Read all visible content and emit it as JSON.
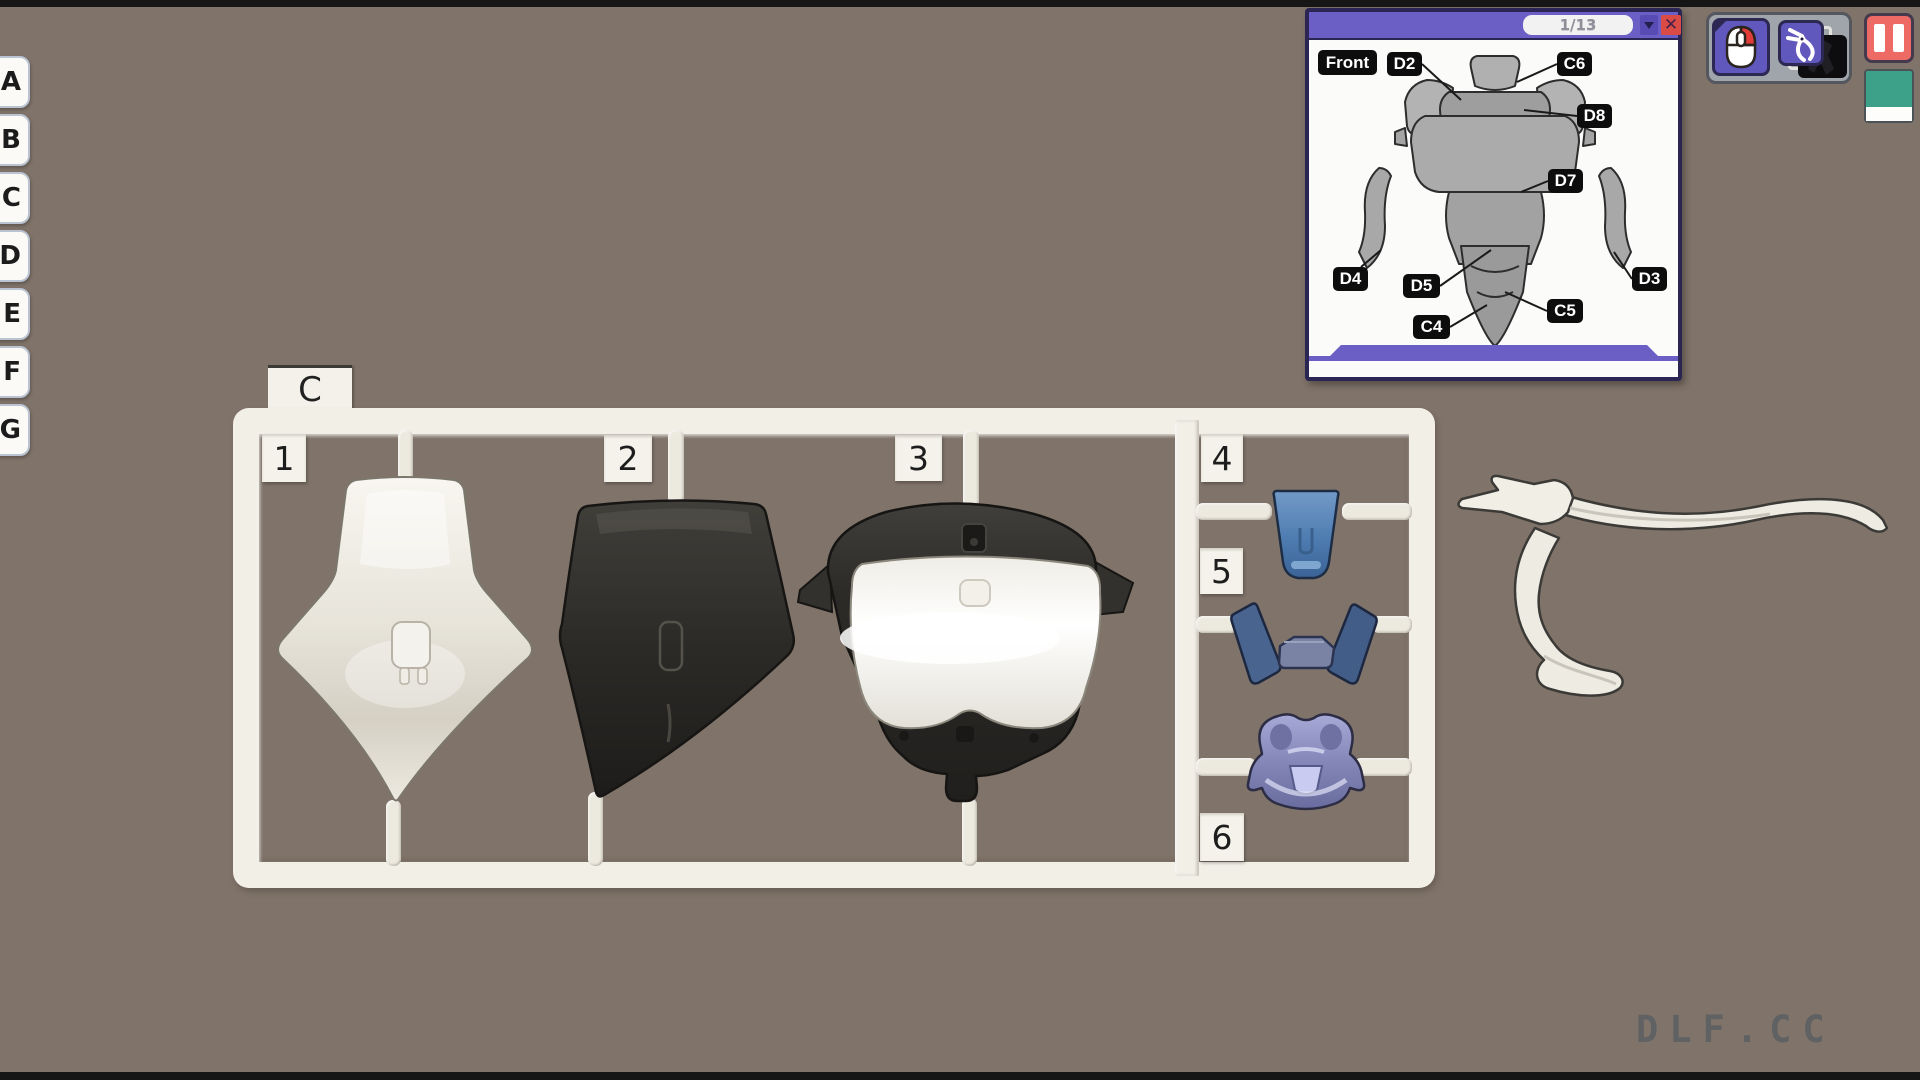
{
  "scene": {
    "watermark": "DLF.CC",
    "background_color": "#80746a",
    "letterbox_color": "#161616"
  },
  "sidebar": {
    "tabs": [
      {
        "label": "A"
      },
      {
        "label": "B"
      },
      {
        "label": "C"
      },
      {
        "label": "D"
      },
      {
        "label": "E"
      },
      {
        "label": "F"
      },
      {
        "label": "G"
      }
    ]
  },
  "sprue": {
    "runner_label": "C",
    "frame_color": "#f2efe7",
    "slots": [
      {
        "number": "1",
        "part": "back-armor-piece-white",
        "color": "#e9e6dd"
      },
      {
        "number": "2",
        "part": "torso-piece-black",
        "color": "#2e2c29"
      },
      {
        "number": "3",
        "part": "chest-unit-black-and-white",
        "color": "#2e2c29 / #f4f2ec"
      },
      {
        "number": "4",
        "part": "waist-plate-blue",
        "color": "#5d87b9"
      },
      {
        "number": "5",
        "part": "collar-straps-navy",
        "color": "#4a618c"
      },
      {
        "number": "6",
        "part": "chest-vent-lavender",
        "color": "#9396c8"
      }
    ]
  },
  "manual": {
    "page_indicator": "1/13",
    "view_label": "Front",
    "accent_color": "#6b5fc5",
    "labels": {
      "d2": "D2",
      "c6": "C6",
      "d8": "D8",
      "d7": "D7",
      "d4": "D4",
      "d5": "D5",
      "c4": "C4",
      "c5": "C5",
      "d3": "D3"
    }
  },
  "hud": {
    "pause_color": "#ee6a65",
    "confirm_color": "#3da189",
    "buttons": [
      {
        "name": "mouse-controls"
      },
      {
        "name": "nipper-tool"
      }
    ]
  }
}
